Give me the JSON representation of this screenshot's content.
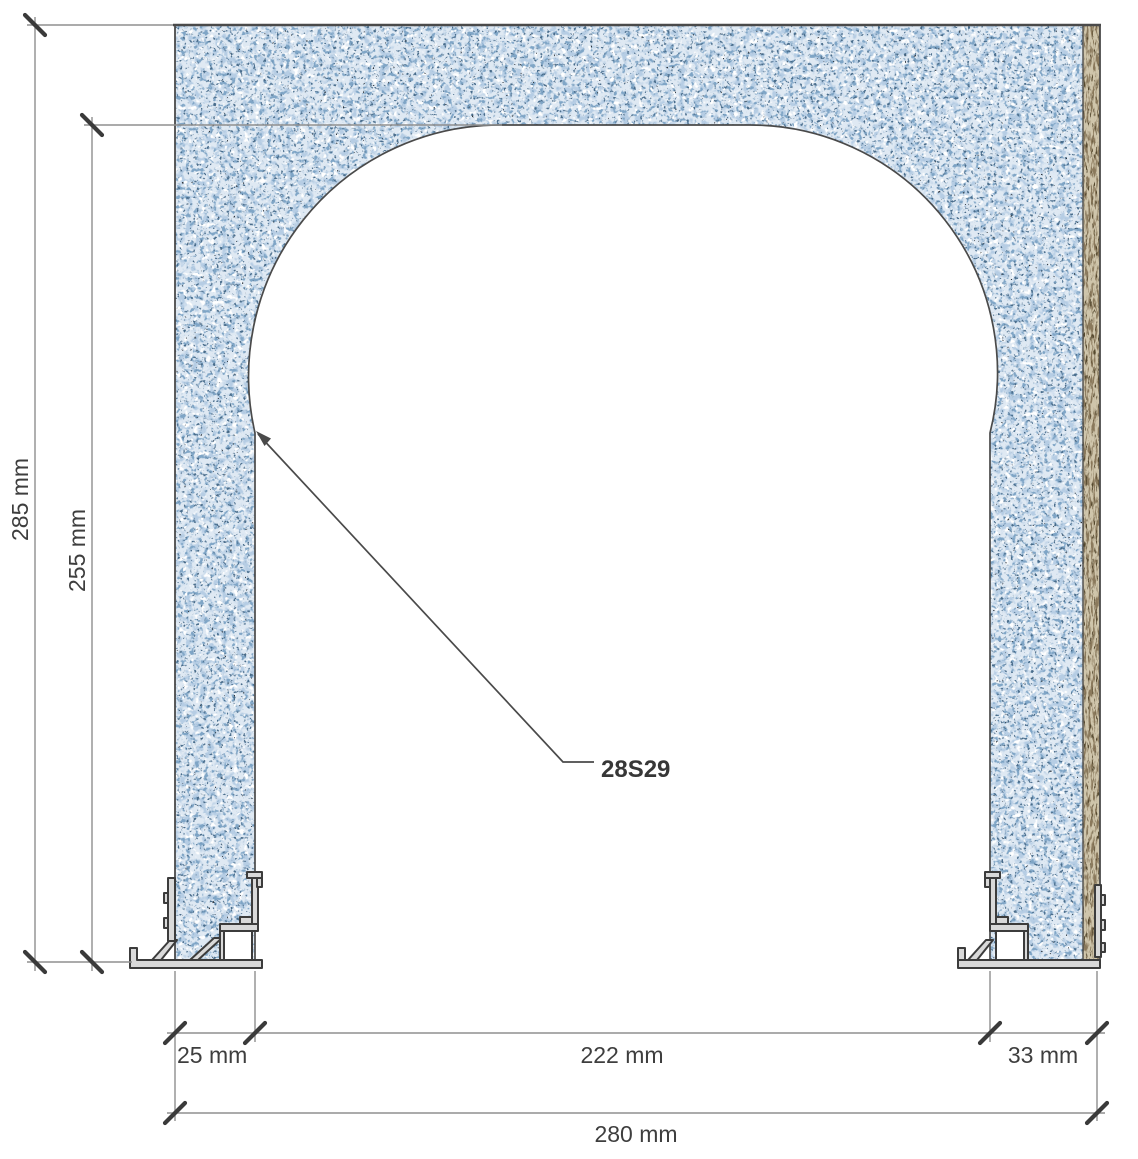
{
  "drawing": {
    "type": "architectural-section-detail",
    "callout": {
      "label": "28S29"
    },
    "dimensions": {
      "overall_height": "285 mm",
      "opening_height": "255 mm",
      "left_jamb_width": "25 mm",
      "opening_width": "222 mm",
      "right_jamb_width": "33 mm",
      "overall_width": "280 mm"
    },
    "materials": {
      "wall": "speckled-plaster-concrete",
      "right_layer": "wood-fibre-board",
      "bottom_trims": "aluminium-profiles"
    },
    "colors": {
      "wall_base": "#dfe9f3",
      "speckle_soft": "#b6cde4",
      "speckle_mid": "#7fa5c6",
      "speckle_deep": "#4a6d8c",
      "fleck_dark": "#2f343a",
      "speckle_white": "#ffffff",
      "board_base": "#cfc5ab",
      "board_grain": "#8a795c",
      "board_grain_dark": "#55482f",
      "outline": "#4a4a4a",
      "dim_line": "#8f8f8f",
      "tick": "#3a3a3a",
      "text": "#3e3e3e",
      "profile_fill": "#d9d9d9",
      "profile_stroke": "#3c3c3c",
      "background": "#ffffff"
    }
  }
}
